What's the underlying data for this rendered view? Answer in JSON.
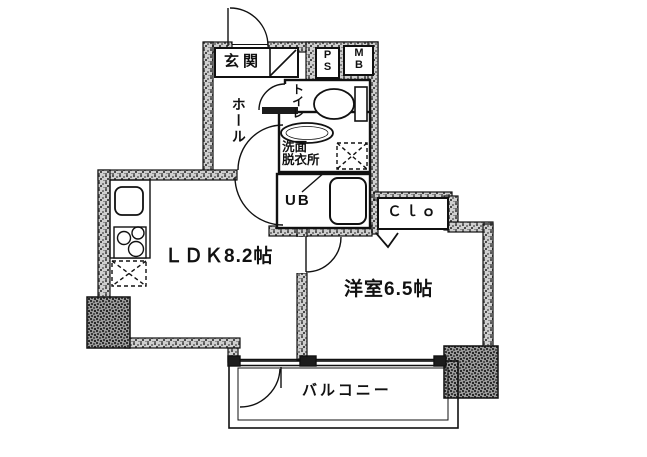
{
  "plan": {
    "type": "apartment-floor-plan",
    "rooms": {
      "genkan": {
        "label": "玄関"
      },
      "pipe_space": {
        "label": "P\nS"
      },
      "meter_box": {
        "label": "M\nB"
      },
      "toilet": {
        "label": "トイレ"
      },
      "hall": {
        "label": "ホール"
      },
      "washroom": {
        "label": "洗面\n脱衣所"
      },
      "unit_bath": {
        "label": "UB"
      },
      "closet": {
        "label": "Ｃｌｏ"
      },
      "ldk": {
        "label": "ＬＤＫ8.2帖",
        "size_tatami": 8.2
      },
      "western_room": {
        "label": "洋室6.5帖",
        "size_tatami": 6.5
      },
      "balcony": {
        "label": "バルコニー"
      }
    },
    "fixtures": [
      "entrance-door-swing",
      "shoe-step-diagonal",
      "toilet-bowl",
      "wash-basin",
      "washing-machine-space",
      "bathtub",
      "kitchen-sink",
      "gas-stove",
      "refrigerator-space",
      "closet-folding-door-chevron",
      "room-door-swings",
      "balcony-sliding-window"
    ],
    "colors": {
      "line": "#111111",
      "wall_speckle": "#8a8a8a",
      "pillar_speckle": "#5a5a5a",
      "background": "#ffffff"
    }
  }
}
